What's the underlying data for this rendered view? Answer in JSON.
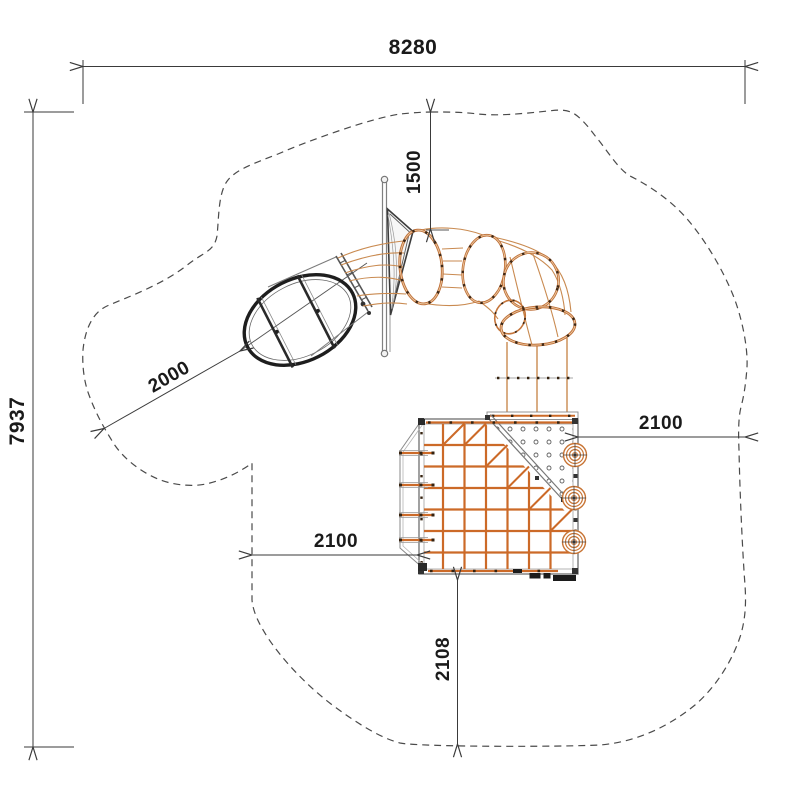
{
  "drawing": {
    "title": "playground-equipment-plan-view",
    "dims": {
      "overall_width": "8280",
      "overall_height": "7937",
      "top_clearance": "1500",
      "slide_clearance": "2000",
      "right_clearance": "2100",
      "left_clearance": "2100",
      "bottom_clearance": "2108"
    },
    "colors": {
      "rope_orange": "#c4753b",
      "net_orange": "#cc6a28",
      "dot_dark": "#35220f",
      "dimension_line": "#3a3a3a",
      "boundary_gray": "#4a4a4a",
      "structure_gray": "#6f6f6f",
      "barrel_dark": "#1e1e1e"
    }
  }
}
